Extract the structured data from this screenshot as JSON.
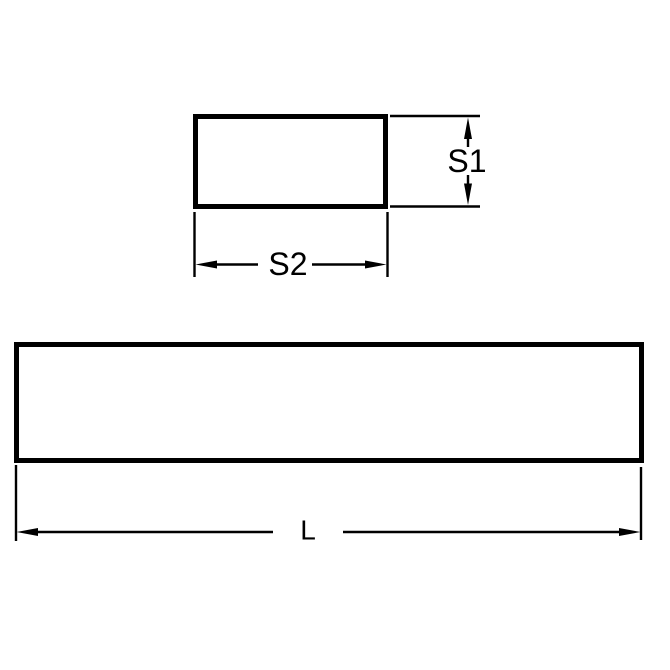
{
  "colors": {
    "ink": "#000000",
    "background": "#ffffff"
  },
  "views": {
    "cross_section": {
      "height_label": "S1",
      "width_label": "S2"
    },
    "side_view": {
      "length_label": "L"
    }
  }
}
